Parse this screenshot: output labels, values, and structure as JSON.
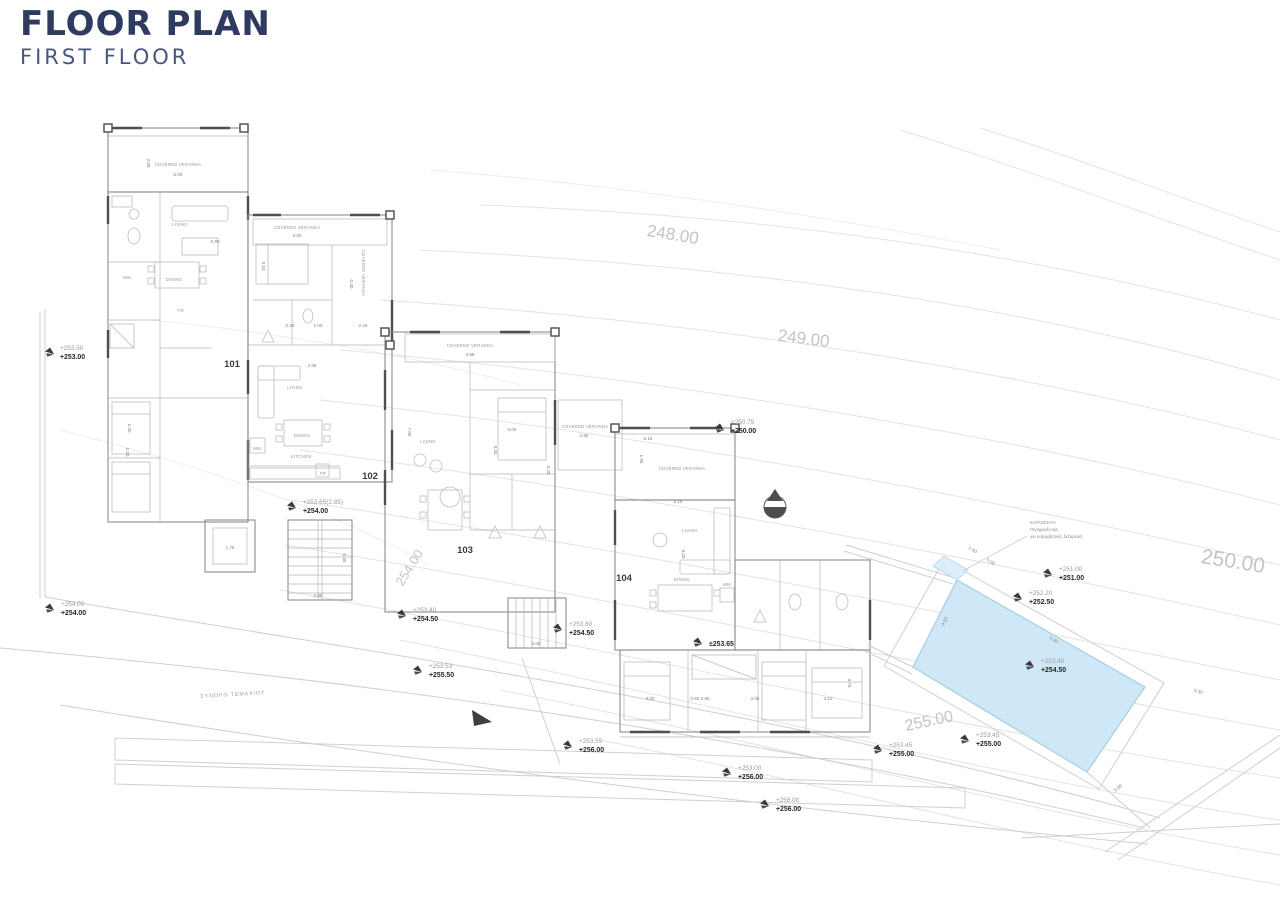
{
  "header": {
    "title": "FLOOR PLAN",
    "subtitle": "FIRST FLOOR"
  },
  "colors": {
    "title_navy": "#2e3b5e",
    "subtitle_navy": "#46577e",
    "pool_fill": "#cfe8f7",
    "pool_stroke": "#a6cde2",
    "contour_gray": "#e3e3e3",
    "contour_label_gray": "#c4c4c4",
    "wall_gray": "#8c8c8c",
    "ink_dark": "#262626"
  },
  "contour_labels": [
    "248.00",
    "249.00",
    "250.00",
    "254.00",
    "255.00"
  ],
  "units": [
    "101",
    "102",
    "103",
    "104"
  ],
  "rooms": [
    "COVERED VERANDA",
    "LIVING",
    "DINING",
    "KITCHEN",
    "WM",
    "FR"
  ],
  "dims": [
    "5.00",
    "2.05",
    "5.90",
    "3.50",
    "3.10",
    "2.43",
    "1.00",
    "2.16",
    "2.85",
    "3.56",
    "2.90",
    "3.05",
    "3.20",
    "3.25",
    "6.16",
    "1.85",
    "6.20",
    "3.00",
    "0.60 2.80",
    "3.06",
    "3.70",
    "1.75",
    "5.45",
    "2.86",
    "5.08",
    "1.40",
    "1.20",
    "9.30",
    "1.50",
    "4.50",
    "7.00",
    "0.40"
  ],
  "levels": [
    {
      "top": "+253.50",
      "bottom": "+253.00"
    },
    {
      "top": "+250.75",
      "bottom": "+250.00"
    },
    {
      "top": "+253.65(2.85)",
      "bottom": "+254.00"
    },
    {
      "top": "+254.00",
      "bottom": "+254.00"
    },
    {
      "top": "+253.40",
      "bottom": "+254.50"
    },
    {
      "top": "+253.60",
      "bottom": "+254.50"
    },
    {
      "top": "±253.65",
      "bottom": ""
    },
    {
      "top": "+253.53",
      "bottom": "+255.50"
    },
    {
      "top": "+253.55",
      "bottom": "+256.00"
    },
    {
      "top": "+253.00",
      "bottom": "+256.00"
    },
    {
      "top": "+256.00",
      "bottom": "+256.00"
    },
    {
      "top": "+253.45",
      "bottom": "+255.00"
    },
    {
      "top": "+253.45",
      "bottom": "+255.00"
    },
    {
      "top": "+251.00",
      "bottom": "+251.00"
    },
    {
      "top": "+252.20",
      "bottom": "+252.50"
    },
    {
      "top": "+253.40",
      "bottom": "+254.50"
    }
  ],
  "notes": {
    "boundary_label": "ΣΥΝΟΡΟ ΤΕΜΑΧΙΟΥ",
    "pool_note_line1": "ΚΑΤΑΣΚΕΥΗ",
    "pool_note_line2": "Περίφραξη ΒΔ",
    "pool_note_line3": "για κολυμβητικές δεξαμενές"
  }
}
